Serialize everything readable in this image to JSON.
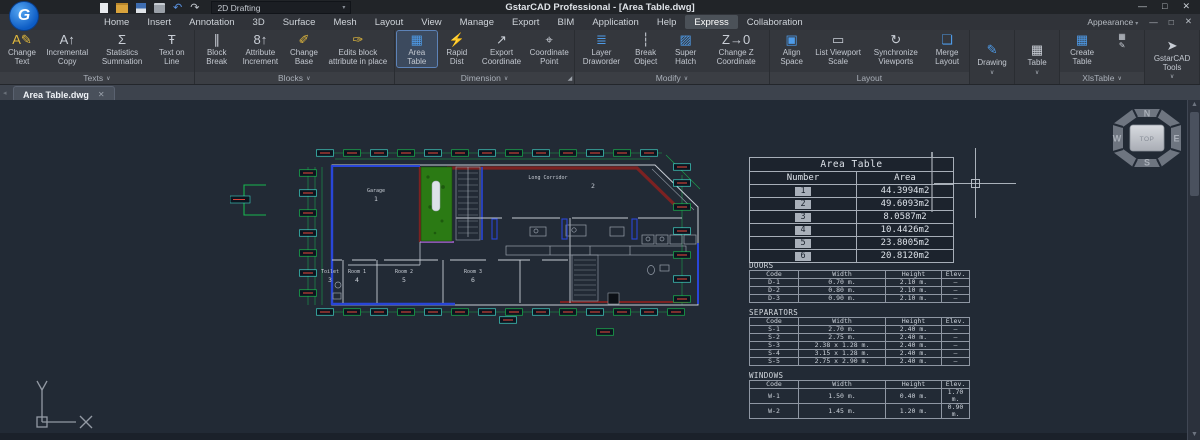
{
  "titlebar": {
    "title": "GstarCAD  Professional - [Area Table.dwg]",
    "workspace": "2D Drafting",
    "quick_access": [
      "new-file-icon",
      "open-file-icon",
      "save-icon",
      "print-icon",
      "undo-icon",
      "redo-icon"
    ],
    "window_controls": {
      "minimize": "—",
      "maximize": "□",
      "close": "✕"
    }
  },
  "menubar": {
    "tabs": [
      "Home",
      "Insert",
      "Annotation",
      "3D",
      "Surface",
      "Mesh",
      "Layout",
      "View",
      "Manage",
      "Export",
      "BIM",
      "Application",
      "Help",
      "Express",
      "Collaboration"
    ],
    "active_tab": "Express",
    "appearance": "Appearance"
  },
  "ribbon": {
    "groups": [
      {
        "label": "Texts",
        "chevron": true,
        "items": [
          {
            "label": "Change Text",
            "icon": "change-text-icon",
            "glyph": "A✎",
            "accent": "#e2b93c"
          },
          {
            "label": "Incremental Copy",
            "icon": "incremental-copy-icon",
            "glyph": "A↑"
          },
          {
            "label": "Statistics Summation",
            "icon": "statistics-summation-icon",
            "glyph": "Σ"
          },
          {
            "label": "Text on Line",
            "icon": "text-on-line-icon",
            "glyph": "Ŧ"
          }
        ]
      },
      {
        "label": "Blocks",
        "chevron": true,
        "items": [
          {
            "label": "Block Break",
            "icon": "block-break-icon",
            "glyph": "∥"
          },
          {
            "label": "Attribute Increment",
            "icon": "attribute-increment-icon",
            "glyph": "8↑"
          },
          {
            "label": "Change Base",
            "icon": "change-base-icon",
            "glyph": "✐",
            "accent": "#e2b93c"
          },
          {
            "label": "Edits block attribute in place",
            "icon": "edit-block-attribute-icon",
            "glyph": "✑",
            "accent": "#e2b93c"
          }
        ]
      },
      {
        "label": "Dimension",
        "chevron": true,
        "launcher": true,
        "items": [
          {
            "label": "Area Table",
            "icon": "area-table-icon",
            "glyph": "▦",
            "accent": "#4e9be8",
            "active": true
          },
          {
            "label": "Rapid Dist",
            "icon": "rapid-dist-icon",
            "glyph": "⚡",
            "accent": "#e2b93c"
          },
          {
            "label": "Export Coordinate",
            "icon": "export-coordinate-icon",
            "glyph": "↗"
          },
          {
            "label": "Coordinate Point",
            "icon": "coordinate-point-icon",
            "glyph": "⌖"
          }
        ]
      },
      {
        "label": "Modify",
        "chevron": true,
        "items": [
          {
            "label": "Layer Draworder",
            "icon": "layer-draworder-icon",
            "glyph": "≣",
            "accent": "#4e9be8"
          },
          {
            "label": "Break Object",
            "icon": "break-object-icon",
            "glyph": "┆"
          },
          {
            "label": "Super Hatch",
            "icon": "super-hatch-icon",
            "glyph": "▨",
            "accent": "#4e9be8"
          },
          {
            "label": "Change Z Coordinate",
            "icon": "change-z-coordinate-icon",
            "glyph": "Z→0"
          }
        ]
      },
      {
        "label": "Layout",
        "chevron": false,
        "items": [
          {
            "label": "Align Space",
            "icon": "align-space-icon",
            "glyph": "▣",
            "accent": "#4e9be8"
          },
          {
            "label": "List Viewport Scale",
            "icon": "list-viewport-scale-icon",
            "glyph": "▭"
          },
          {
            "label": "Synchronize Viewports",
            "icon": "synchronize-viewports-icon",
            "glyph": "↻"
          },
          {
            "label": "Merge Layout",
            "icon": "merge-layout-icon",
            "glyph": "❏",
            "accent": "#4e9be8"
          }
        ]
      },
      {
        "label": "Drawing",
        "type": "dropdown",
        "icon": "drawing-icon",
        "glyph": "✎",
        "accent": "#4e9be8"
      },
      {
        "label": "Table",
        "type": "dropdown",
        "icon": "table-icon",
        "glyph": "▦"
      },
      {
        "label": "XlsTable",
        "chevron": true,
        "items": [
          {
            "label": "Create Table",
            "icon": "create-table-icon",
            "glyph": "▦",
            "accent": "#4e9be8"
          },
          {
            "label": "",
            "icon": "xlstable-mini-icons",
            "glyph": "▦\n✎",
            "mini": true
          }
        ]
      },
      {
        "label": "GstarCAD Tools",
        "type": "dropdown",
        "icon": "gstarcad-tools-icon",
        "glyph": "➤"
      }
    ]
  },
  "doc_tab": {
    "label": "Area Table.dwg",
    "close": "✕",
    "nav": "◂"
  },
  "canvas": {
    "rooms": [
      {
        "name": "Garage",
        "number": "1"
      },
      {
        "name": "Long Corridor",
        "number": "2"
      },
      {
        "name": "Toilet",
        "number": "3"
      },
      {
        "name": "Room 1",
        "number": "4"
      },
      {
        "name": "Room 2",
        "number": "5"
      },
      {
        "name": "Room 3",
        "number": "6"
      }
    ],
    "area_table": {
      "title": "Area Table",
      "columns": [
        "Number",
        "Area"
      ],
      "rows": [
        {
          "number": "1",
          "area": "44.3994m2"
        },
        {
          "number": "2",
          "area": "49.6093m2"
        },
        {
          "number": "3",
          "area": "8.0587m2"
        },
        {
          "number": "4",
          "area": "10.4426m2"
        },
        {
          "number": "5",
          "area": "23.8005m2"
        },
        {
          "number": "6",
          "area": "20.8120m2"
        }
      ]
    },
    "spec_tables": [
      {
        "title": "DOORS",
        "columns": [
          "Code",
          "Width",
          "Height",
          "Elev."
        ],
        "rows": [
          [
            "D-1",
            "0.70 m.",
            "2.10 m.",
            "—"
          ],
          [
            "D-2",
            "0.80 m.",
            "2.10 m.",
            "—"
          ],
          [
            "D-3",
            "0.90 m.",
            "2.10 m.",
            "—"
          ]
        ]
      },
      {
        "title": "SEPARATORS",
        "columns": [
          "Code",
          "Width",
          "Height",
          "Elev."
        ],
        "rows": [
          [
            "S-1",
            "2.70 m.",
            "2.40 m.",
            "—"
          ],
          [
            "S-2",
            "2.75 m.",
            "2.40 m.",
            "—"
          ],
          [
            "S-3",
            "2.38 x 1.28 m.",
            "2.40 m.",
            "—"
          ],
          [
            "S-4",
            "3.15 x 1.28 m.",
            "2.40 m.",
            "—"
          ],
          [
            "S-5",
            "2.75 x 2.90 m.",
            "2.40 m.",
            "—"
          ]
        ]
      },
      {
        "title": "WINDOWS",
        "columns": [
          "Code",
          "Width",
          "Height",
          "Elev."
        ],
        "rows": [
          [
            "W-1",
            "1.50 m.",
            "0.40 m.",
            "1.70 m."
          ],
          [
            "W-2",
            "1.45 m.",
            "1.20 m.",
            "0.90 m."
          ]
        ]
      }
    ],
    "navcube": {
      "top": "TOP",
      "north": "N",
      "east": "E",
      "south": "S",
      "west": "W"
    }
  },
  "colors": {
    "canvas_bg": "#222a35",
    "dim_green": "#18b54f",
    "dim_cyan": "#3fd2c4",
    "dim_red": "#d8453a",
    "wall_blue": "#2946d8",
    "wall_red": "#7c2222",
    "hatch_green": "#2b7a14",
    "accent_blue": "#4e9be8"
  }
}
